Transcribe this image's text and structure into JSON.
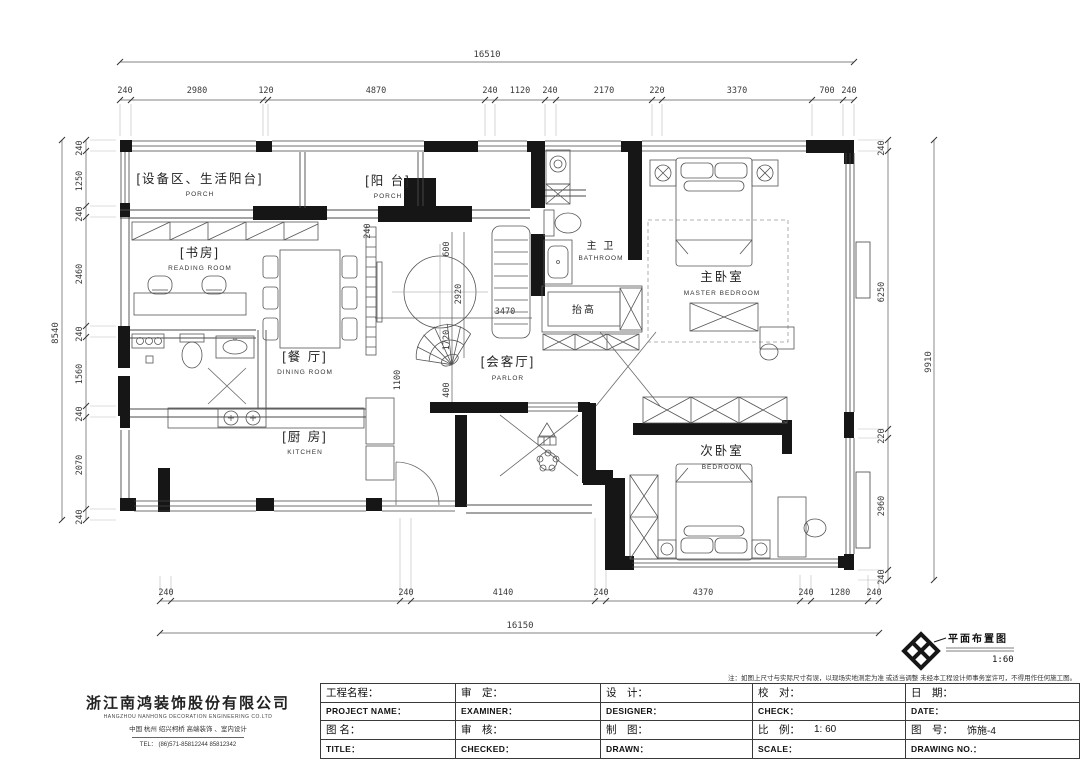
{
  "sheet": {
    "legend": {
      "title": "平面布置图",
      "scale": "1:60"
    },
    "note": "注：如图上尺寸与实际尺寸有误，以现场实地测定为准 或适当调整 未经本工程设计师事务室许可，不得用作任何施工图。"
  },
  "company": {
    "name": "浙江南鸿装饰股份有限公司",
    "name_en": "HANGZHOU NANHONG DECORATION ENGINEERING CO.LTD",
    "tagline": "中国 杭州 绍兴柯桥 高端装饰 、室内设计",
    "tel": "TEL： (86)571-85812244  85812342"
  },
  "titleblock": {
    "project_cn": "工程名程：",
    "project_en": "PROJECT NAME：",
    "examine_cn": "审　定：",
    "examine_en": "EXAMINER：",
    "design_cn": "设　计：",
    "design_en": "DESIGNER：",
    "check_cn": "校　对：",
    "check_en": "CHECK：",
    "date_cn": "日　期：",
    "date_en": "DATE：",
    "title_cn": "图 名：",
    "title_en": "TITLE：",
    "audit_cn": "审　核：",
    "audit_en": "CHECKED：",
    "draft_cn": "制　图：",
    "draft_en": "DRAWN：",
    "scale_cn": "比　例：",
    "scale_val": "1: 60",
    "scale_en": "SCALE：",
    "no_cn": "图　号：",
    "no_val": "饰施-4",
    "no_en": "DRAWING NO.："
  },
  "rooms": {
    "porch1": {
      "cn": "[设备区、生活阳台]",
      "en": "PORCH"
    },
    "porch2": {
      "cn": "[阳 台]",
      "en": "PORCH"
    },
    "reading": {
      "cn": "[书房]",
      "en": "READING ROOM"
    },
    "dining": {
      "cn": "[餐 厅]",
      "en": "DINING ROOM"
    },
    "parlor": {
      "cn": "[会客厅]",
      "en": "PARLOR"
    },
    "bathroom": {
      "cn": "主 卫",
      "en": "BATHROOM"
    },
    "raised": {
      "cn": "抬高"
    },
    "master": {
      "cn": "主卧室",
      "en": "MASTER BEDROOM"
    },
    "kitchen": {
      "cn": "[厨 房]",
      "en": "KITCHEN"
    },
    "bedroom": {
      "cn": "次卧室",
      "en": "BEDROOM"
    }
  },
  "dims": {
    "top_total": "16510",
    "top": [
      "240",
      "2980",
      "120",
      "4870",
      "240",
      "1120",
      "240",
      "2170",
      "220",
      "3370",
      "700",
      "240"
    ],
    "left_total": "8540",
    "left": [
      "240",
      "1250",
      "240",
      "2460",
      "240",
      "1560",
      "240",
      "2070",
      "240"
    ],
    "right_total": "9910",
    "right": [
      "240",
      "6250",
      "220",
      "2960",
      "240"
    ],
    "bottom_total": "16150",
    "bottom": [
      "240",
      "240",
      "4140",
      "240",
      "4370",
      "240",
      "1280",
      "240"
    ],
    "inner": {
      "v240": "240",
      "v600": "600",
      "v1720": "1720",
      "v2920": "2920",
      "v400": "400",
      "v1100": "1100",
      "h3470": "3470"
    }
  }
}
